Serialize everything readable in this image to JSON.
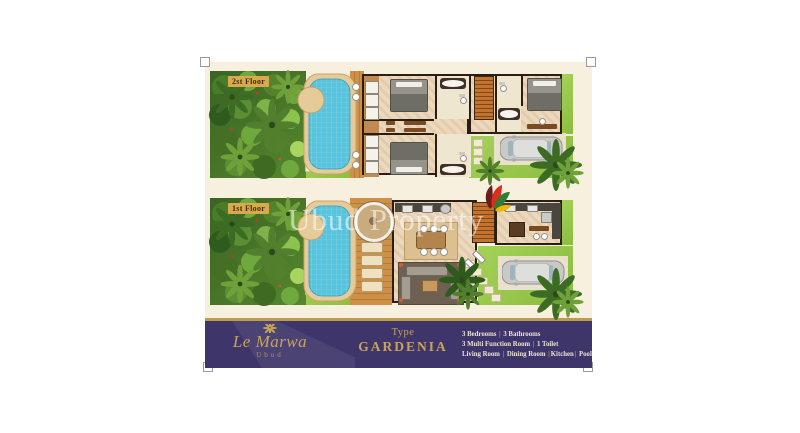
{
  "plans": {
    "floor2": {
      "label": "2st Floor"
    },
    "floor1": {
      "label": "1st Floor"
    }
  },
  "watermark": {
    "text": "Ubud Property",
    "logo": "flower-logo"
  },
  "footer": {
    "brand": {
      "name": "Le Marwa",
      "location": "Ubud",
      "icon": "palm-icon"
    },
    "type": {
      "prefix": "Type",
      "name": "GARDENIA"
    },
    "features": {
      "line1": "3 Bedrooms | 3 Bathrooms",
      "line2": "3 Multi Function Room | 1 Toilet",
      "line3": "Living Room | Dining Room |Kitchen| Pool"
    }
  },
  "colors": {
    "accent_gold": "#c9a458",
    "bar_purple": "#3e356a",
    "sheet_cream": "#f7f0df",
    "pool_blue": "#5fc4dd",
    "grass_green": "#9ccb52",
    "wall_brown": "#2b1d12"
  }
}
